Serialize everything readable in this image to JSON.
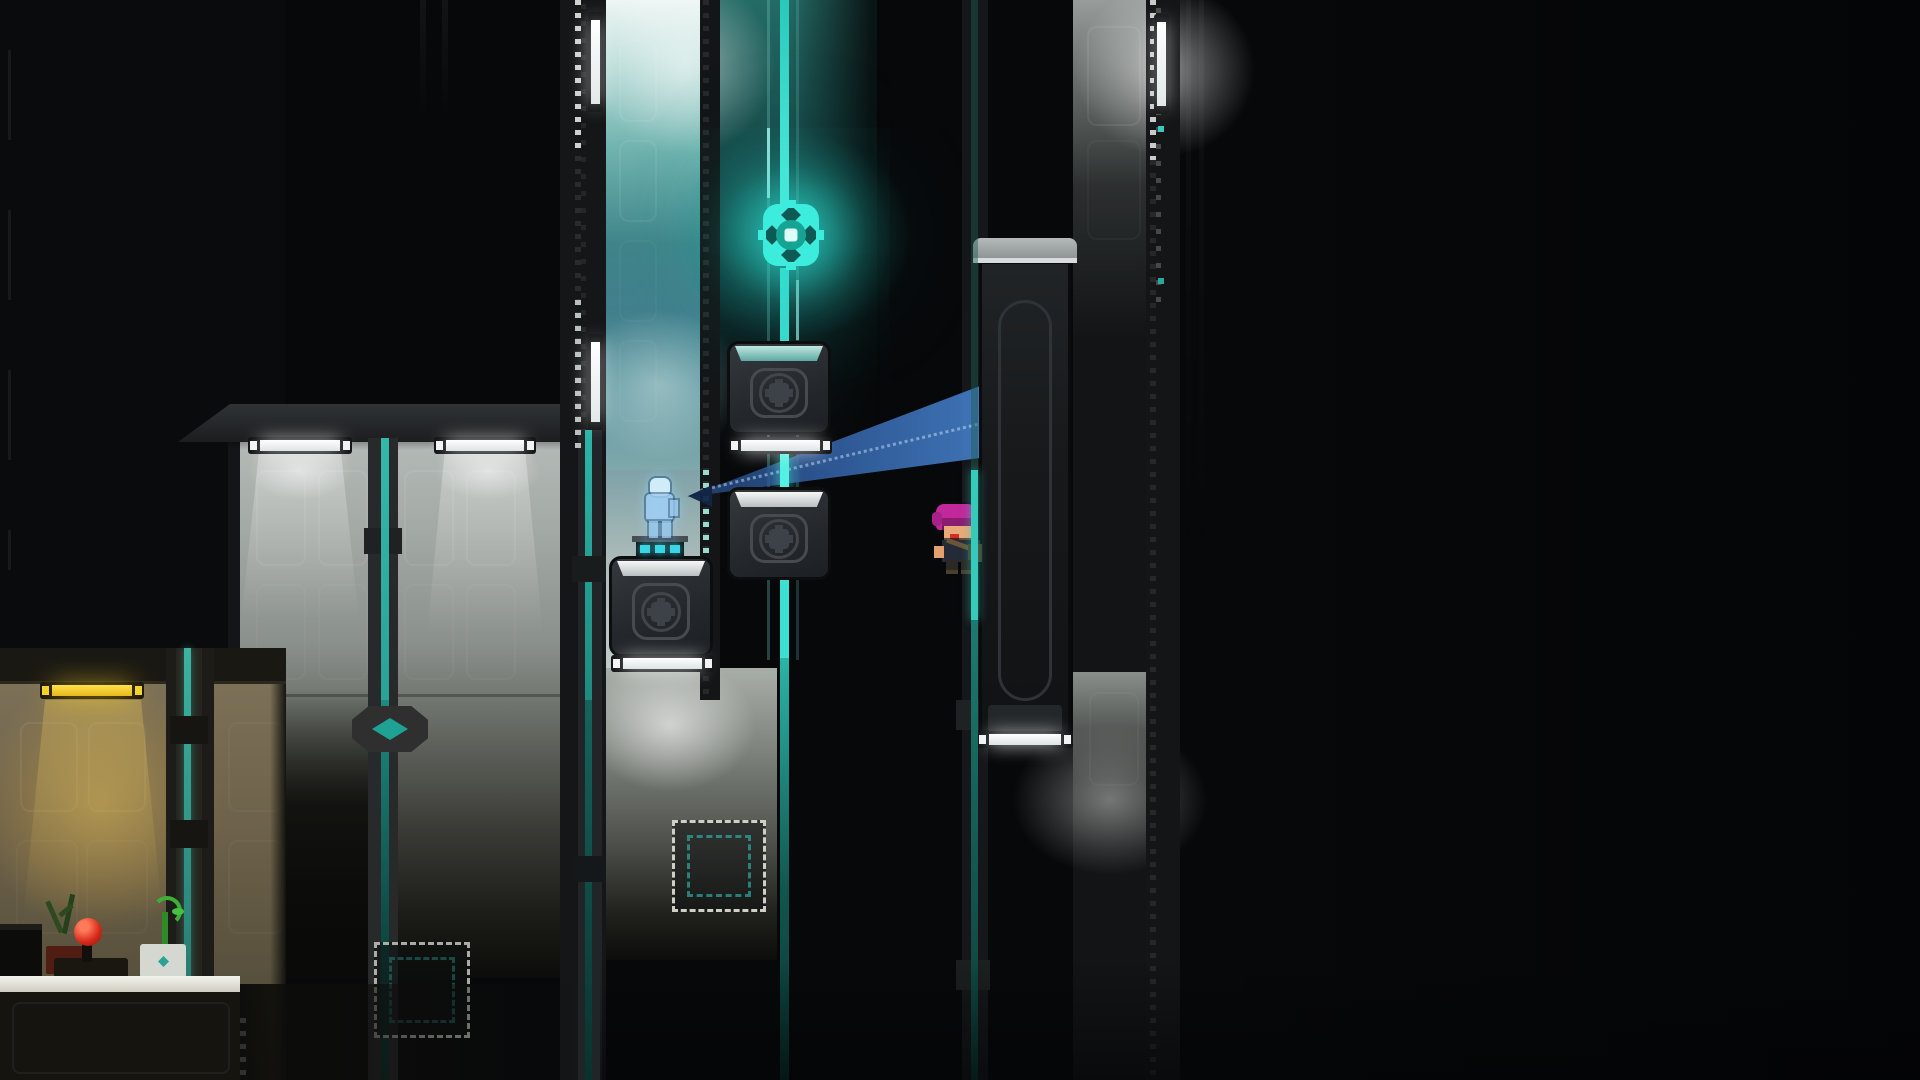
{
  "meta": {
    "domain": "Game",
    "description": "Dark sci-fi pixel-art platformer room scene, side view, no HUD text visible",
    "visible_text": []
  },
  "palette": {
    "background": "#07080a",
    "rail_teal": "#36cabb",
    "rail_teal_dim": "#155a54",
    "orb_cyan": "#3cecdc",
    "beam_blue": "#3a72bc",
    "beam_tip_navy": "#14284b",
    "lamp_white": "#ffffff",
    "lamp_yellow": "#f4ce2a",
    "wall_gray_lit": "#b4bab7",
    "wall_teal_lit": "#6fb2ae",
    "wall_warm": "#7c7057",
    "crate_body": "#2b3034",
    "hair_magenta": "#c0289c",
    "skin": "#e9aa7a",
    "hologram_blue": "#a8d2ee",
    "joystick_red": "#d42818",
    "plant_green": "#3fae36"
  },
  "scene": {
    "entities": [
      {
        "name": "glowing-orb",
        "kind": "pickup",
        "x": 762,
        "y": 203,
        "w": 58,
        "h": 64,
        "color": "#3cecdc"
      },
      {
        "name": "energy-rail-center",
        "kind": "rail",
        "x": 780,
        "y": 0,
        "w": 9,
        "h": 1080
      },
      {
        "name": "crate-upper",
        "kind": "pushable-crate",
        "x": 727,
        "y": 341,
        "w": 104,
        "h": 94,
        "top_band": "teal"
      },
      {
        "name": "crate-middle",
        "kind": "pushable-crate",
        "x": 727,
        "y": 487,
        "w": 104,
        "h": 93,
        "top_band": "white"
      },
      {
        "name": "crate-large",
        "kind": "pushable-crate",
        "x": 609,
        "y": 556,
        "w": 104,
        "h": 101,
        "top_band": "white"
      },
      {
        "name": "platform-bar-upper",
        "kind": "light-platform",
        "x": 729,
        "y": 437,
        "w": 103,
        "h": 17
      },
      {
        "name": "platform-bar-large",
        "kind": "light-platform",
        "x": 611,
        "y": 655,
        "w": 103,
        "h": 17
      },
      {
        "name": "hologram-figure",
        "kind": "hologram",
        "x": 641,
        "y": 478,
        "w": 38,
        "h": 62
      },
      {
        "name": "hologram-pedestal",
        "kind": "pedestal",
        "x": 632,
        "y": 536,
        "w": 56,
        "h": 20,
        "lights": 3
      },
      {
        "name": "player-character",
        "kind": "player",
        "x": 934,
        "y": 504,
        "w": 52,
        "h": 66,
        "hair": "#c0289c"
      },
      {
        "name": "scan-beam",
        "kind": "beam",
        "apex": [
          687,
          497
        ],
        "right_top": [
          980,
          386
        ],
        "right_bottom": [
          980,
          458
        ]
      },
      {
        "name": "sliding-door",
        "kind": "door",
        "x": 979,
        "y": 238,
        "w": 92,
        "h": 510
      },
      {
        "name": "door-light-bar",
        "kind": "light-platform",
        "x": 977,
        "y": 731,
        "w": 96,
        "h": 17
      },
      {
        "name": "wall-tube-left",
        "kind": "ceiling-light",
        "x": 248,
        "y": 437,
        "w": 104,
        "h": 17,
        "color": "white"
      },
      {
        "name": "wall-tube-right",
        "kind": "ceiling-light",
        "x": 434,
        "y": 437,
        "w": 102,
        "h": 17,
        "color": "white"
      },
      {
        "name": "yellow-tube",
        "kind": "ceiling-light",
        "x": 40,
        "y": 682,
        "w": 104,
        "h": 17,
        "color": "yellow"
      },
      {
        "name": "vertical-lamp-1",
        "kind": "rail-lamp",
        "x": 588,
        "y": 12,
        "w": 15,
        "h": 100
      },
      {
        "name": "vertical-lamp-2",
        "kind": "rail-lamp",
        "x": 588,
        "y": 334,
        "w": 15,
        "h": 96
      },
      {
        "name": "vertical-lamp-3",
        "kind": "rail-lamp",
        "x": 1154,
        "y": 14,
        "w": 15,
        "h": 100
      },
      {
        "name": "socket-panel-teal",
        "kind": "crate-socket",
        "x": 672,
        "y": 820,
        "w": 94,
        "h": 92
      },
      {
        "name": "socket-panel-dim",
        "kind": "crate-socket",
        "x": 374,
        "y": 942,
        "w": 96,
        "h": 96
      },
      {
        "name": "rail-diamond-node",
        "kind": "rail-node",
        "x": 352,
        "y": 706,
        "w": 76,
        "h": 46
      },
      {
        "name": "desk",
        "kind": "furniture",
        "x": 0,
        "y": 976,
        "w": 240,
        "h": 104
      },
      {
        "name": "joystick",
        "kind": "prop",
        "x": 54,
        "y": 918,
        "w": 74,
        "h": 60,
        "ball": "#d42818"
      },
      {
        "name": "monitor",
        "kind": "prop",
        "x": 0,
        "y": 924,
        "w": 42,
        "h": 56
      },
      {
        "name": "dried-plant",
        "kind": "prop",
        "x": 44,
        "y": 898,
        "w": 44,
        "h": 76
      },
      {
        "name": "potted-sprout",
        "kind": "prop",
        "x": 140,
        "y": 896,
        "w": 48,
        "h": 82
      }
    ],
    "rooms": [
      {
        "name": "gray-lit-room",
        "x": 228,
        "y": 404,
        "w": 347,
        "h": 560
      },
      {
        "name": "teal-holo-room",
        "x": 605,
        "y": 0,
        "w": 95,
        "h": 700
      },
      {
        "name": "orb-backwall",
        "x": 712,
        "y": 0,
        "w": 165,
        "h": 450
      },
      {
        "name": "yellow-room",
        "x": 0,
        "y": 648,
        "w": 286,
        "h": 432
      },
      {
        "name": "right-wall-column",
        "x": 1073,
        "y": 0,
        "w": 96,
        "h": 1080
      }
    ]
  }
}
